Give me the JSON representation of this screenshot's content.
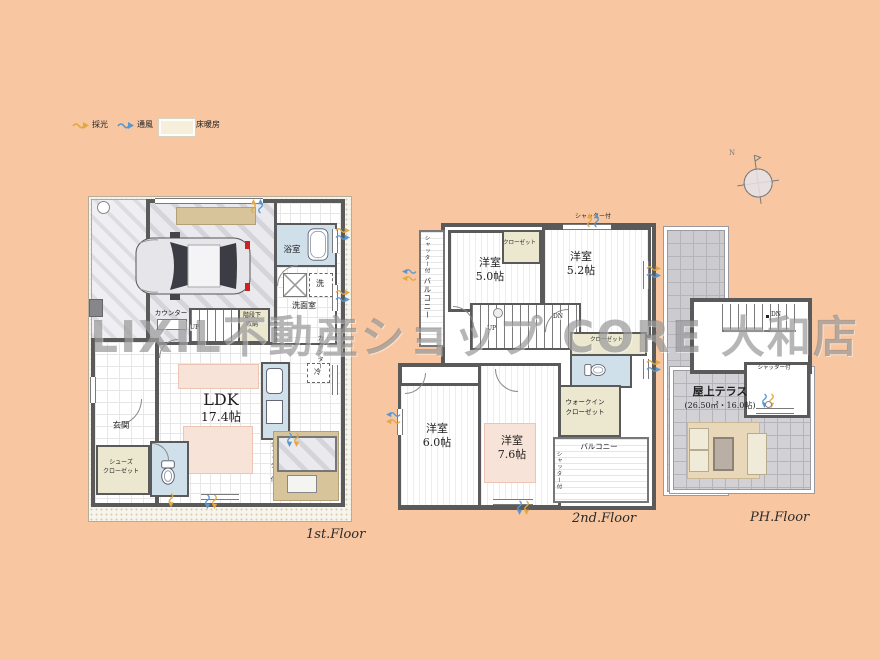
{
  "watermark_text": "LIXIL不動産ショップ CORE 大和店",
  "legend": {
    "lighting": "採光",
    "ventilation": "通風",
    "floor_heating": "床暖房"
  },
  "compass": {
    "north": "N"
  },
  "colors": {
    "background": "#F8C7A2",
    "wall": "#5A5A5A",
    "floor_heating_fill": "#F8E3D8",
    "wet_room": "#CFE0EA",
    "closet": "#ECE8CF",
    "terrace_tan": "#D8C49A",
    "daylight_arrow": "#E2A844",
    "airflow_arrow": "#5B97CF"
  },
  "floors": {
    "f1": {
      "label": "1st.Floor",
      "bath": "浴室",
      "washer": "洗",
      "washroom": "洗面室",
      "stair_storage_1": "階段下",
      "stair_storage_2": "収納",
      "counter": "カウンター",
      "up": "UP",
      "ldk_1": "LDK",
      "ldk_2": "17.4帖",
      "entrance": "玄関",
      "shoes_1": "シューズ",
      "shoes_2": "クローゼット",
      "fridge": "冷",
      "shutter": "シャッター付"
    },
    "f2": {
      "label": "2nd.Floor",
      "shutter_top": "シャッター付",
      "closet_a": "クローゼット",
      "room50_1": "洋室",
      "room50_2": "5.0帖",
      "room52_1": "洋室",
      "room52_2": "5.2帖",
      "shutter_left": "シャッター付",
      "balcony_left": "バルコニー",
      "up": "UP",
      "dn": "DN",
      "closet_b": "クローゼット",
      "closet_c": "クローゼット",
      "room60_1": "洋室",
      "room60_2": "6.0帖",
      "room76_1": "洋室",
      "room76_2": "7.6帖",
      "wic_1": "ウォークイン",
      "wic_2": "クローゼット",
      "balcony_right": "バルコニー",
      "shutter_right": "シャッター付"
    },
    "ph": {
      "label": "PH.Floor",
      "dn": "DN",
      "shutter": "シャッター付",
      "terrace_1": "屋上テラス",
      "terrace_2": "(26.50㎡・16.0帖)"
    }
  }
}
